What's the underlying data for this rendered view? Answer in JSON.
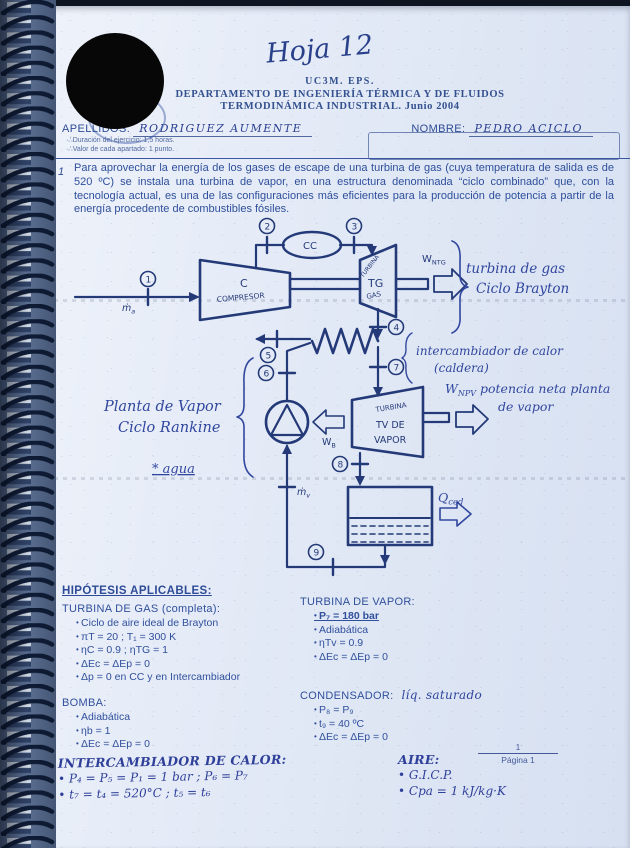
{
  "header": {
    "sheet_label": "Hoja 12",
    "institution": "UC3M. EPS.",
    "department": "DEPARTAMENTO DE INGENIERÍA TÉRMICA Y DE FLUIDOS",
    "course": "TERMODINÁMICA INDUSTRIAL. Junio 2004",
    "apellidos_label": "APELLIDOS:",
    "apellidos_value": "RODRIGUEZ  AUMENTE",
    "nombre_label": "NOMBRE:",
    "nombre_value": "PEDRO  ACICLO",
    "notes": [
      "Duración del ejercicio: 1,5 horas.",
      "Valor de cada apartado: 1 punto."
    ]
  },
  "problem": {
    "number": "1",
    "text": "Para aprovechar la energía de los gases de escape de una turbina de gas (cuya temperatura de salida es de 520 ºC) se instala una turbina de vapor, en una estructura denominada “ciclo combinado” que, con la tecnología actual, es una de las configuraciones más eficientes para la producción de potencia a partir de la energía procedente de combustibles fósiles."
  },
  "diagram": {
    "states": [
      "1",
      "2",
      "3",
      "4",
      "5",
      "6",
      "7",
      "8",
      "9"
    ],
    "compressor": {
      "letter": "C",
      "name": "COMPRESOR"
    },
    "combustion_chamber": "CC",
    "gas_turbine": {
      "l1": "TURBINA",
      "l2": "TG",
      "l3": "GAS"
    },
    "steam_turbine": {
      "l1": "TURBINA",
      "l2": "TV DE",
      "l3": "VAPOR"
    },
    "w_ntg": {
      "main": "W",
      "sub": "NTG"
    },
    "w_b": {
      "main": "W",
      "sub": "B"
    },
    "w_npv": {
      "main": "W",
      "sub": "NPV",
      "rest": " potencia neta planta",
      "line2": "de vapor"
    },
    "q_ced": {
      "main": "Q",
      "sub": "ced"
    },
    "m_air": {
      "main": "ṁ",
      "sub": "a"
    },
    "m_vap": {
      "main": "ṁ",
      "sub": "v"
    },
    "ann_gas_1": "turbina de gas",
    "ann_gas_2": "Ciclo Brayton",
    "ann_hx_1": "intercambiador de calor",
    "ann_hx_2": "(caldera)",
    "ann_rankine_1": "Planta de Vapor",
    "ann_rankine_2": "Ciclo Rankine",
    "ann_agua": "* agua"
  },
  "hypotheses": {
    "title": "HIPÓTESIS APLICABLES:",
    "gas_turbine": {
      "title": "TURBINA DE GAS (completa):",
      "items": [
        "Ciclo de aire ideal de Brayton",
        "πT = 20  ;  T₁ = 300 K",
        "ηC = 0.9 ; ηTG = 1",
        "ΔEc = ΔEp = 0",
        "Δp = 0 en CC y en Intercambiador"
      ]
    },
    "bomba": {
      "title": "BOMBA:",
      "items": [
        "Adiabática",
        "ηb = 1",
        "ΔEc = ΔEp = 0"
      ]
    },
    "intercambiador": {
      "title": "INTERCAMBIADOR DE CALOR:",
      "items": [
        "P₄ = P₅ = P₁ = 1 bar  ;  P₆ = P₇",
        "t₇ = t₄ = 520°C  ;  t₅ = t₆"
      ]
    },
    "vapor_turbine": {
      "title": "TURBINA DE VAPOR:",
      "items": [
        "P₇ = 180 bar",
        "Adiabática",
        "ηTv = 0.9",
        "ΔEc = ΔEp = 0"
      ]
    },
    "condensador": {
      "title": "CONDENSADOR:",
      "note": "líq. saturado",
      "items": [
        "P₈ = P₉",
        "t₉ = 40 ºC",
        "ΔEc = ΔEp = 0"
      ]
    },
    "aire": {
      "title": "AIRE:",
      "items": [
        "G.I.C.P.",
        "Cpa = 1 kJ/kg·K"
      ]
    }
  },
  "footer": {
    "numerator": "1",
    "label": "Página 1"
  }
}
